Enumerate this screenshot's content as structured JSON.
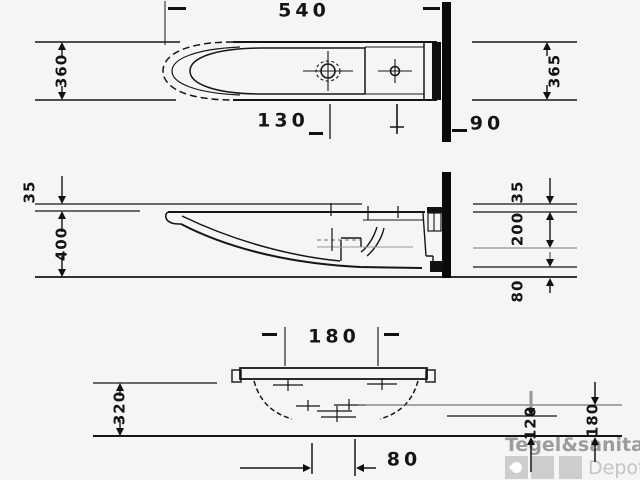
{
  "colors": {
    "background": "#f5f5f5",
    "ink": "#161616",
    "gray_line": "#8a8a8a",
    "watermark_text": "#9c9c9c",
    "watermark_block": "#cdcdcd",
    "watermark_sub": "#c4c4c4"
  },
  "dimensions": {
    "top_view": {
      "overall_width": "540",
      "depth_left": "360",
      "depth_right": "365",
      "drain_to_tap": "130",
      "tap_to_wall": "90"
    },
    "side_view": {
      "rim_band_left": "35",
      "overall_height": "400",
      "rim_band_right": "35",
      "rim_to_outlet": "200",
      "outlet_to_base": "80"
    },
    "front_view": {
      "tap_centres": "180",
      "bowl_height": "320",
      "drain_offset": "80",
      "outlet_height": "120",
      "inlet_height": "180"
    }
  },
  "watermark": {
    "brand": "Tegel&sanitair",
    "sub": "Depot"
  }
}
